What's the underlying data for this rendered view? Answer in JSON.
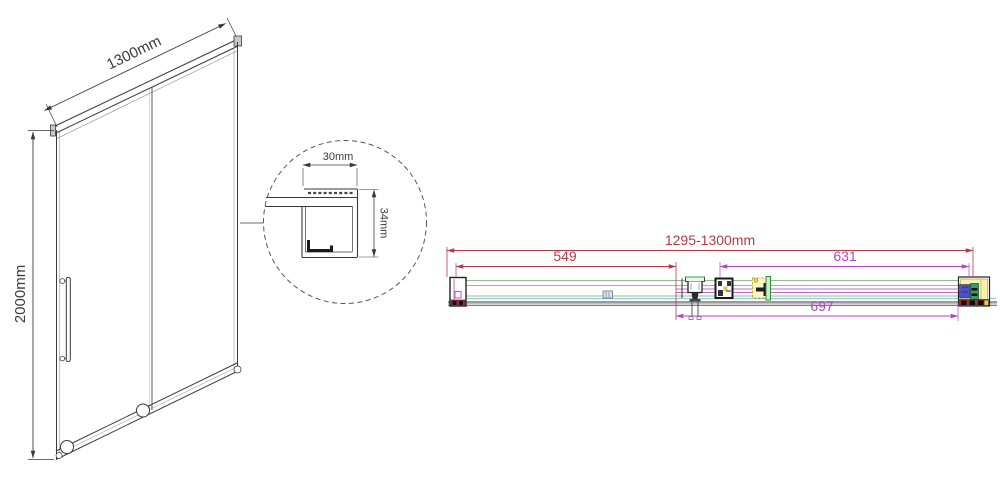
{
  "drawing": {
    "front_view": {
      "width_label": "1300mm",
      "height_label": "2000mm"
    },
    "detail_view": {
      "width_label": "30mm",
      "height_label": "34mm"
    },
    "plan_view": {
      "overall_label": "1295-1300mm",
      "left_segment_label": "549",
      "right_segment_label": "631",
      "bottom_segment_label": "697"
    }
  },
  "colors": {
    "line_dark": "#3a3a3a",
    "dim_red": "#b23c46",
    "dim_magenta": "#b445c8",
    "glass_green": "#8fbf8f",
    "seal_cyan": "#72bdbd",
    "panel_gray": "#9a9aa0",
    "hardware_yellow": "#f7f0ae",
    "hardware_blue": "#4a52c8",
    "hardware_teal": "#2f9e6e",
    "hardware_darkred": "#9a3030"
  }
}
